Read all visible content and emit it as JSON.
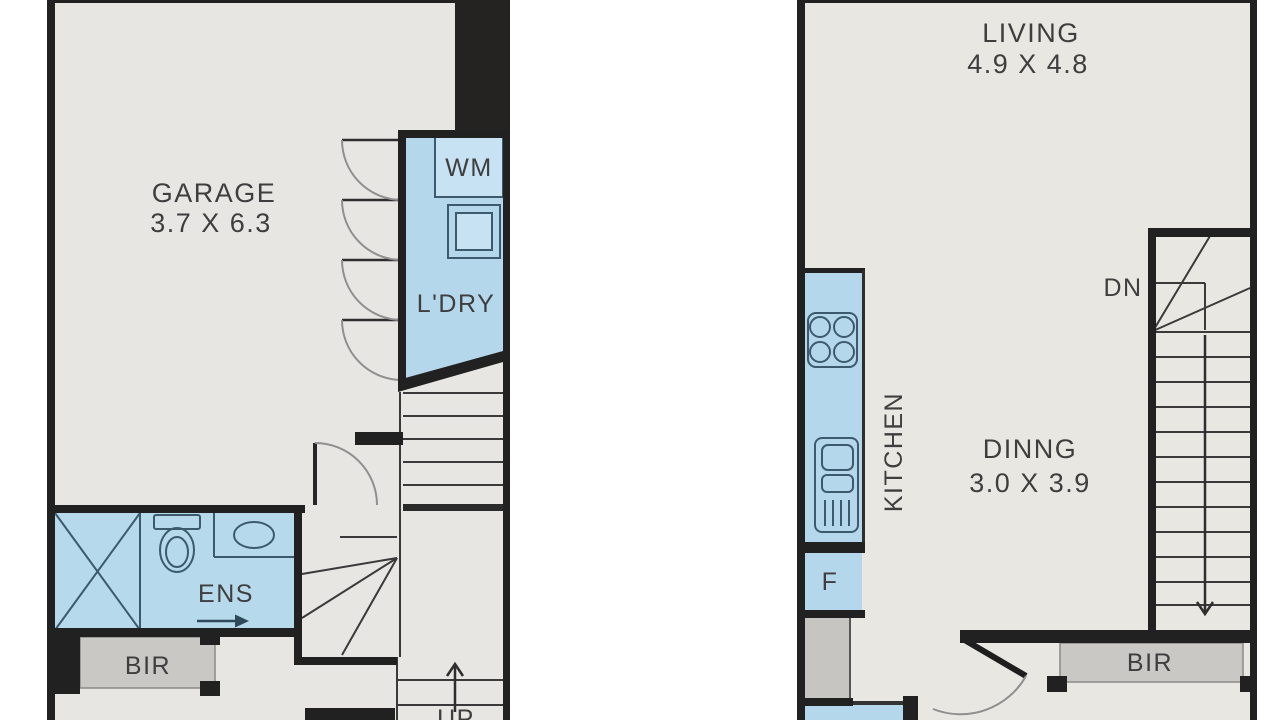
{
  "plan": {
    "colors": {
      "wall": "#212121",
      "floor_ground": "#e7e6e3",
      "floor_first": "#e9e7e1",
      "wet_area": "#b5d7ec",
      "wet_area_light": "#c6e2f3",
      "fixture_stroke": "#3c5a6b",
      "joinery_gray": "#c9c8c5",
      "text": "#3e3e3e",
      "background": "#ffffff"
    },
    "ground_floor": {
      "garage": {
        "label": "GARAGE",
        "dims": "3.7 X 6.3"
      },
      "laundry": {
        "label": "L'DRY",
        "washer": "WM"
      },
      "ensuite": {
        "label": "ENS"
      },
      "robe": {
        "label": "BIR"
      },
      "stairs": {
        "label": "UP"
      }
    },
    "first_floor": {
      "living": {
        "label": "LIVING",
        "dims": "4.9 X 4.8"
      },
      "kitchen": {
        "label": "KITCHEN",
        "fridge": "F"
      },
      "dining": {
        "label": "DINNG",
        "dims": "3.0 X 3.9"
      },
      "robe": {
        "label": "BIR"
      },
      "stairs": {
        "label": "DN"
      }
    }
  }
}
